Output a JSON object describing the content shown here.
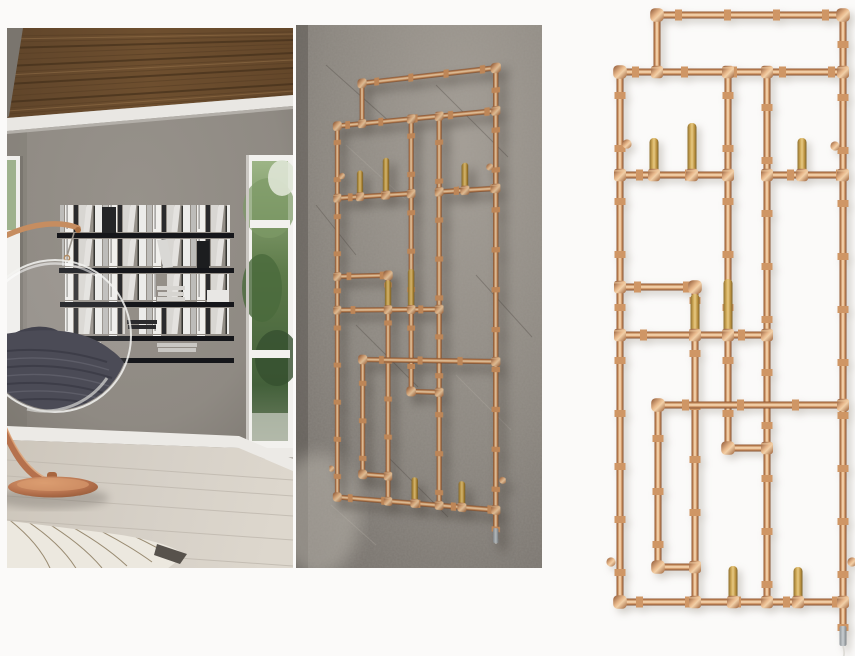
{
  "collage": {
    "panel_count": 3,
    "panels": [
      {
        "id": "room-photo"
      },
      {
        "id": "wall-photo"
      },
      {
        "id": "white-render"
      }
    ]
  },
  "rack": {
    "pegs_upper_row": 3,
    "pegs_middle_row": 2,
    "pegs_bottom_row": 2,
    "wall_mounts": 4,
    "has_power_cable": true
  },
  "palette": {
    "white_bg": "#fbfaf9",
    "copper_hi": "#f3d2ab",
    "copper_mid": "#cf9463",
    "copper_dark": "#7c4a2b",
    "peg_wood": "#cfa956",
    "wall_stone": "#8b867f",
    "room_wall": "#8f8a83",
    "ceiling_wood": "#6e4f2f",
    "molding": "#e9e7e3",
    "shelf_black": "#15161a",
    "book_white": "#e6e5e2",
    "floor_wood": "#d6d0c7",
    "rug": "#ece8df",
    "blanket": "#4b4b56",
    "foliage": "#66804f",
    "chrome": "#c9ced1",
    "cable": "#dcdad5"
  }
}
